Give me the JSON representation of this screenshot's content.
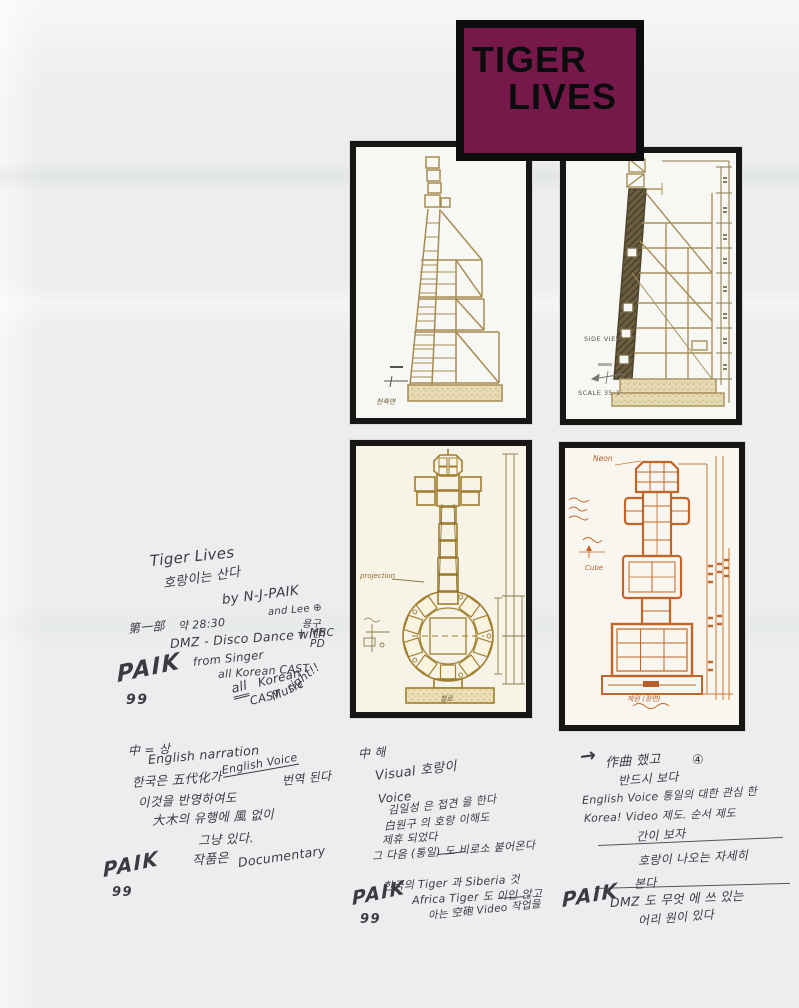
{
  "banner": {
    "line1": "TIGER",
    "line2": "LIVES"
  },
  "drawings": {
    "front": {
      "caption": "전측면"
    },
    "side": {
      "view_label": "SIDE VIEW",
      "scale_label": "SCALE 35:1"
    },
    "cello": {
      "projection_label": "projection",
      "caption": "첼로"
    },
    "totem": {
      "neon_label": "Neon",
      "cube_label": "Cube",
      "caption": "제원 (정면)"
    }
  },
  "notes": {
    "c1": [
      "Tiger Lives",
      "호랑이는 산다",
      "by N-J-PAIK",
      "and Lee ⊕",
      "용구",
      "+ MBC",
      "PD",
      "第一部",
      "약 28:30",
      "DMZ - Disco Dance with",
      "from Singer",
      "all Korean CAST",
      "all",
      "Korean",
      "CAST",
      "Music",
      "right!!",
      "PAIK",
      "99"
    ],
    "c2": [
      "中 = 상",
      "English narration",
      "한국은 五代化가",
      "English Voice",
      "번역 된다",
      "이것을 반영하여도",
      "大木의 유행에 風 없이",
      "그냥 있다.",
      "작품은",
      "Documentary",
      "PAIK",
      "99"
    ],
    "c3": [
      "中 해",
      "Visual 호랑이",
      "Voice",
      "김일성 은 접견 을 한다",
      "白원구 의 호랑 이해도",
      "제휴 되었다",
      "그 다음 (통일) 도 비로소 붙어온다",
      "한국의 Tiger 과 Siberia 것",
      "Africa Tiger 도 이인 않고",
      "아는 空砲 Video 작업을",
      "PAIK",
      "99"
    ],
    "c4": [
      "→",
      "作曲 했고",
      "④",
      "반드시 보다",
      "English Voice 통일의 대한 관심 한",
      "Korea! Video 제도. 순서 제도",
      "간이 보자",
      "호랑이 나오는 자세히",
      "본다",
      "PAIK",
      "DMZ 도 무엇 에 쓰 있는",
      "어리 원이 있다"
    ]
  },
  "palette": {
    "banner_bg": "#76194a",
    "banner_border": "#0d0d0d",
    "paper": "#ebedee",
    "ink_tan": "#a8905a",
    "ink_gold": "#a08030",
    "ink_rust": "#c0662a",
    "pen": "#3b3c42"
  }
}
